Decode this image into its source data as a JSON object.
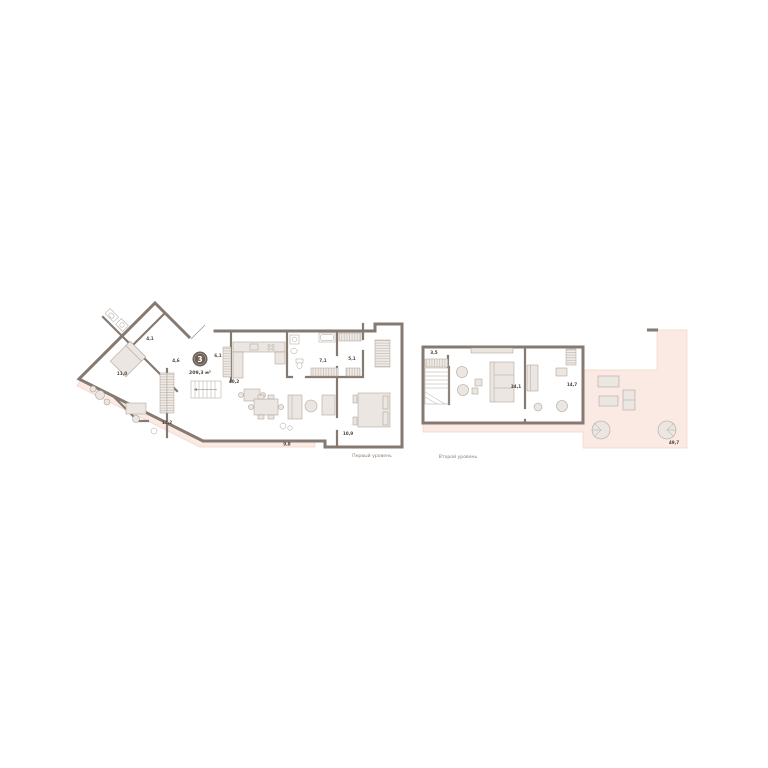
{
  "apartment": {
    "rooms_badge": "3",
    "total_area": "209,3 м²"
  },
  "level1": {
    "caption": "Первый уровень",
    "areas": {
      "wc": "4,1",
      "room1": "11,0",
      "hall_small": "4,6",
      "hall": "6,1",
      "kitchen_living": "40,2",
      "bathroom": "7,1",
      "wardrobe": "5,1",
      "room2": "11,2",
      "bedroom": "10,9",
      "terrace": "9,8"
    }
  },
  "level2": {
    "caption": "Второй уровень",
    "areas": {
      "storage": "3,5",
      "living": "34,1",
      "room": "14,7",
      "terrace": "49,7"
    }
  },
  "colors": {
    "wall": "#857A71",
    "terrace_fill": "#FBEAE4",
    "terrace_stroke": "#F1D3C9",
    "furniture_fill": "#EBE6E1",
    "badge_bg": "#6C6057",
    "badge_text": "#FFFFFF",
    "label_text": "#4C423A",
    "caption_text": "#8B8077"
  }
}
